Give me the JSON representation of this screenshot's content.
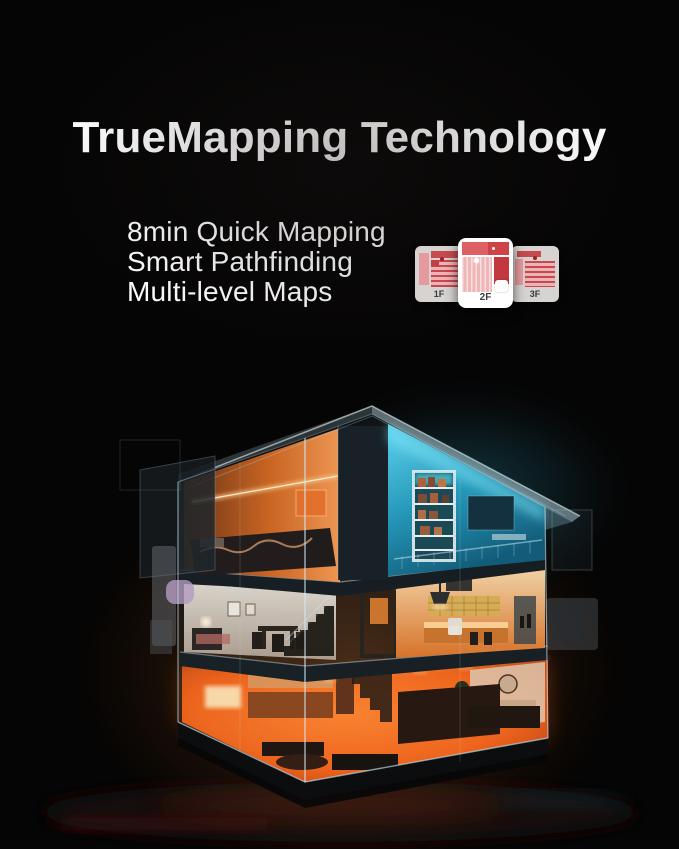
{
  "page": {
    "background_color": "#060505",
    "width": 679,
    "height": 849
  },
  "headline": {
    "text": "TrueMapping Technology",
    "color": "#ffffff"
  },
  "features": {
    "color": "#ffffff",
    "items": [
      "8min Quick Mapping",
      "Smart Pathfinding",
      "Multi-level Maps"
    ]
  },
  "floor_selector": {
    "cards": [
      {
        "label": "1F",
        "elevated": false
      },
      {
        "label": "2F",
        "elevated": true
      },
      {
        "label": "3F",
        "elevated": false
      }
    ],
    "colors": {
      "card_back": "#d6d3d1",
      "card_front": "#ffffff",
      "map_red_dark": "#c2383e",
      "map_red": "#c8484e",
      "map_pink": "#eab4b6",
      "label": "#3c3c3c"
    }
  },
  "illustration": {
    "description": "Night-time cutaway 3D render of a three-story home: cyan-lit attic under the roof, warm white and amber second floor with kitchen, intensely orange-lit first floor living room, translucent glass walls",
    "colors": {
      "roof_glow_cyan": "#35c5e6",
      "attic_warm": "#ff8f3f",
      "first_floor_hot": "#ff6a18",
      "glass_edge": "#bfe3ee",
      "background": "#000000"
    }
  }
}
